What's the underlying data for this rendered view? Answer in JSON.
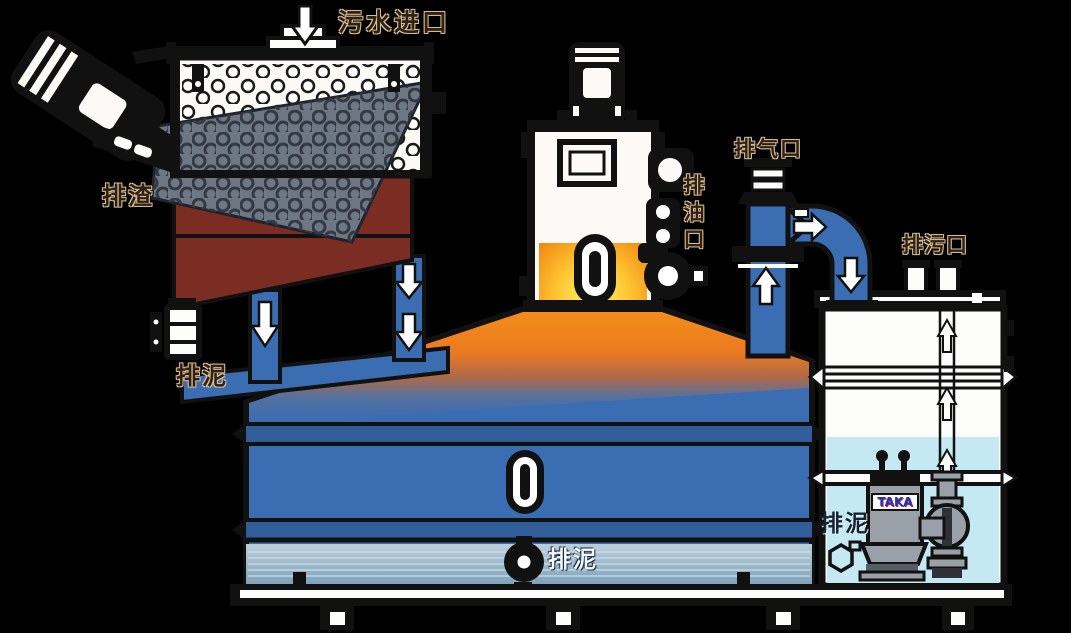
{
  "diagram": {
    "type": "wastewater-treatment-equipment-cutaway",
    "labels": {
      "inlet": "污水进口",
      "slag_discharge": "排渣",
      "sludge_discharge_left": "排泥",
      "exhaust_port": "排气口",
      "oil_discharge_port": "排油口",
      "drain_port": "排污口",
      "sludge_discharge_center": "排泥",
      "sludge_discharge_right": "排泥",
      "pump_brand": "TAKA"
    },
    "colors": {
      "background": "#000000",
      "tank_blue": "#3a6db1",
      "hopper_maroon": "#7b2d24",
      "screen_gray": "#6e7884",
      "oil_orange": "#f08018",
      "oil_yellow": "#fff46a",
      "water_cyan": "#c4e9f2",
      "label_tan": "#d8bd96",
      "outline": "#111111",
      "pump_gray": "#9aa0a8"
    }
  }
}
